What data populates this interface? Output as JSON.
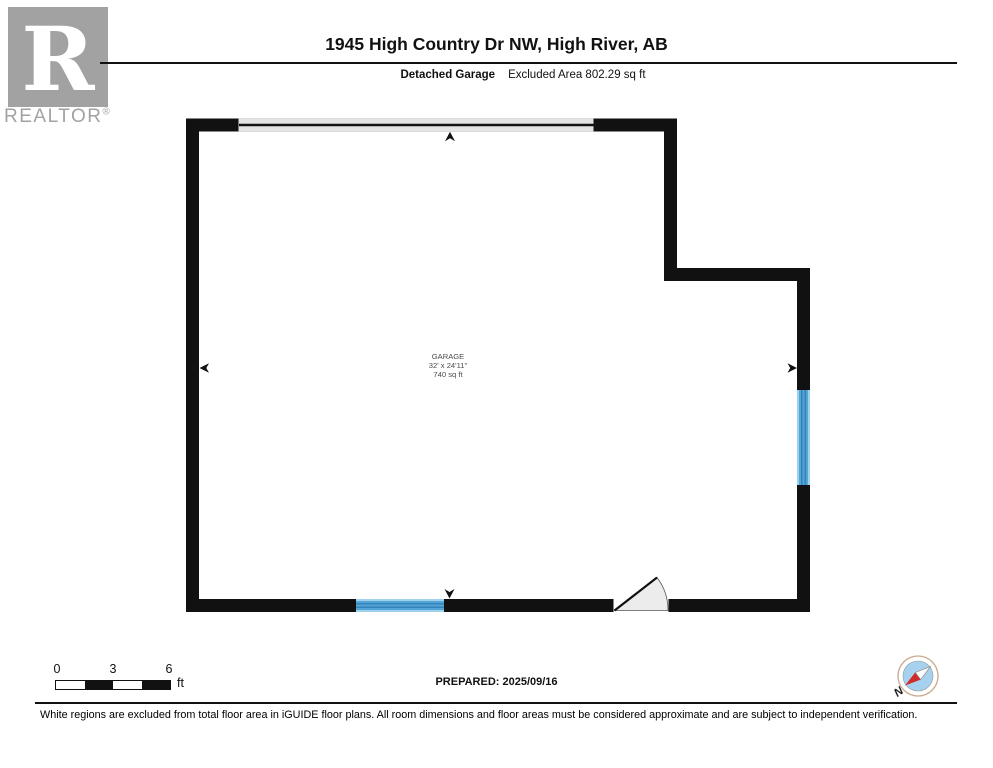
{
  "brand": {
    "logo_letter": "R",
    "name": "REALTOR",
    "reg_mark": "®"
  },
  "header": {
    "title": "1945 High Country Dr NW, High River, AB",
    "floor_label": "Detached Garage",
    "area_label": "Excluded Area 802.29 sq ft"
  },
  "floor_plan": {
    "room": {
      "name": "GARAGE",
      "dimensions": "32' x 24'11\"",
      "area": "740 sq ft"
    }
  },
  "scale_bar": {
    "labels": [
      "0",
      "3",
      "6"
    ],
    "unit": "ft"
  },
  "compass": {
    "north_label": "N"
  },
  "footer": {
    "prepared": "PREPARED: 2025/09/16",
    "disclaimer": "White regions are excluded from total floor area in iGUIDE floor plans. All room dimensions and floor areas must be considered approximate and are subject to independent verification."
  },
  "colors": {
    "wall": "#111111",
    "window_blue": "#54a5d7",
    "window_blue_dark": "#2a78b0",
    "window_blue_light": "#9fd0ec",
    "garage_door_gray": "#e3e3e3",
    "door_swing_gray": "#ececec",
    "logo_gray": "#a2a2a2",
    "compass_red": "#d22b2b",
    "compass_blue": "#a6d2ef"
  }
}
